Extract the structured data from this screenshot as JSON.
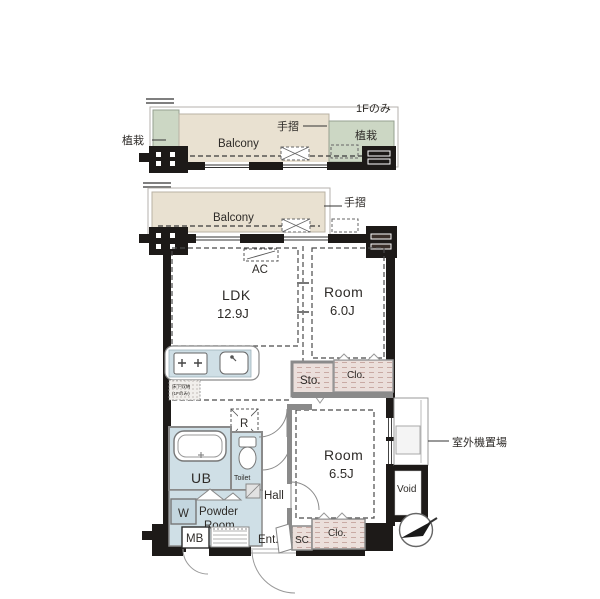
{
  "floor_note": "1Fのみ",
  "balcony_upper": {
    "label": "Balcony",
    "plant_left": "植栽",
    "plant_right": "植栽",
    "handrail": "手摺"
  },
  "balcony_lower": {
    "label": "Balcony",
    "handrail": "手摺"
  },
  "rooms": {
    "ldk": {
      "name": "LDK",
      "size": "12.9J"
    },
    "room_60": {
      "name": "Room",
      "size": "6.0J"
    },
    "room_65": {
      "name": "Room",
      "size": "6.5J"
    }
  },
  "labels": {
    "ac": "AC",
    "sto": "Sto.",
    "clo_upper": "Clo.",
    "clo_lower": "Clo.",
    "sc": "SC",
    "ub": "UB",
    "toilet": "Toilet",
    "hall": "Hall",
    "powder_line1": "Powder",
    "powder_line2": "Room",
    "washer": "W",
    "fridge": "R",
    "mb": "MB",
    "ent": "Ent.",
    "void": "Void",
    "outdoor_unit": "室外機置場",
    "underfloor_line1": "床下収納",
    "underfloor_line2": "(1Fのみ)"
  },
  "colors": {
    "wall": "#1d1a18",
    "balcony": "#e9e1d1",
    "plant": "#ccd7c4",
    "water": "#cfdfe6",
    "closet_hatch": "#ebdfdb",
    "interior_wall": "#8a8a8a"
  }
}
